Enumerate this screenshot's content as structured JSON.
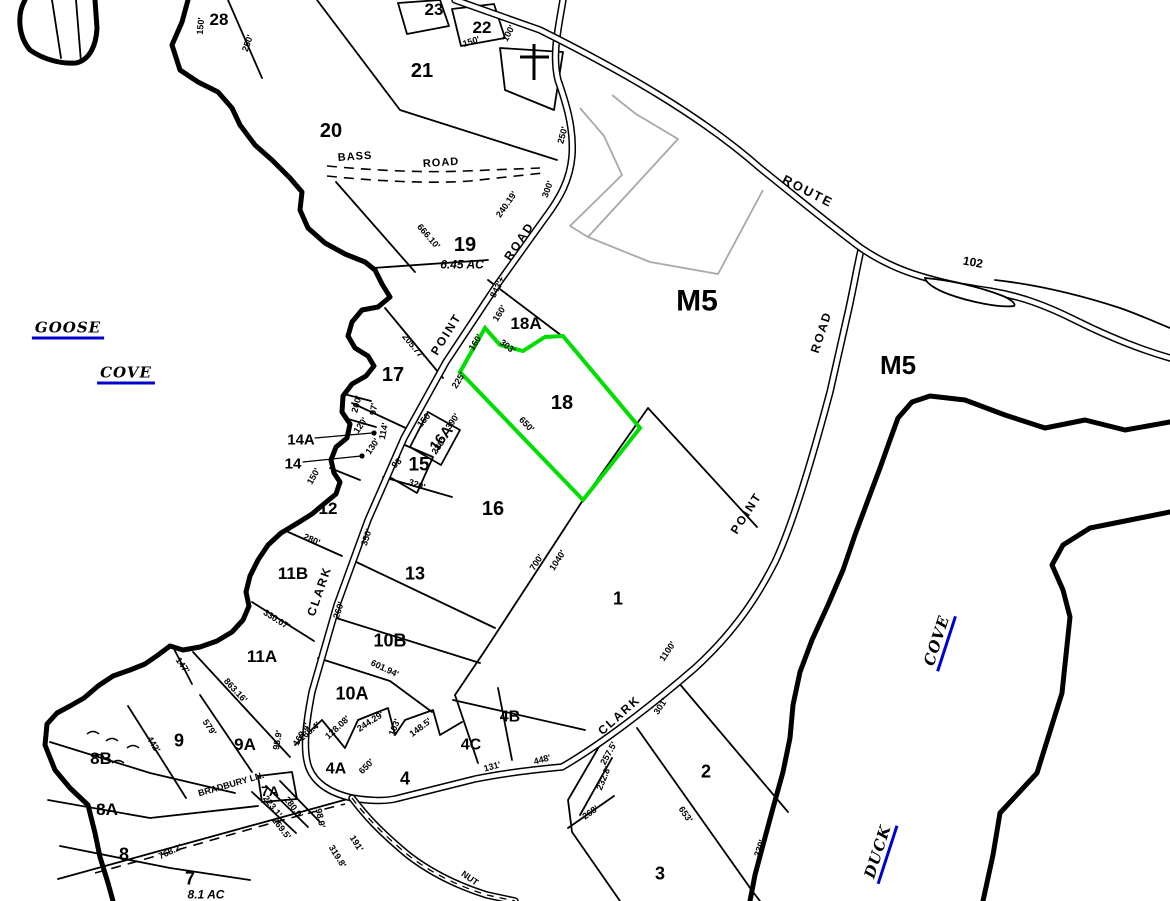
{
  "map": {
    "colors": {
      "highlight_green": "#00dd00",
      "water_label_blue": "#0000cc",
      "subdivision_gray": "#a8a8a8",
      "line_black": "#000000"
    },
    "selected_parcel": "18",
    "region_labels": [
      {
        "text": "28",
        "x": 219,
        "y": 19,
        "size": 17
      },
      {
        "text": "23",
        "x": 434,
        "y": 9,
        "size": 17
      },
      {
        "text": "22",
        "x": 482,
        "y": 27,
        "size": 17
      },
      {
        "text": "21",
        "x": 422,
        "y": 70,
        "size": 20
      },
      {
        "text": "20",
        "x": 331,
        "y": 130,
        "size": 20
      },
      {
        "text": "19",
        "x": 465,
        "y": 244,
        "size": 20
      },
      {
        "text": "18A",
        "x": 526,
        "y": 323,
        "size": 17
      },
      {
        "text": "18",
        "x": 562,
        "y": 402,
        "size": 20
      },
      {
        "text": "17",
        "x": 393,
        "y": 374,
        "size": 20
      },
      {
        "text": "16A",
        "x": 441,
        "y": 438,
        "size": 15,
        "rot": -52
      },
      {
        "text": "15",
        "x": 419,
        "y": 464,
        "size": 19
      },
      {
        "text": "14A",
        "x": 301,
        "y": 439,
        "size": 15
      },
      {
        "text": "14",
        "x": 293,
        "y": 463,
        "size": 15
      },
      {
        "text": "12",
        "x": 328,
        "y": 508,
        "size": 17
      },
      {
        "text": "16",
        "x": 493,
        "y": 508,
        "size": 20
      },
      {
        "text": "11B",
        "x": 293,
        "y": 573,
        "size": 17
      },
      {
        "text": "13",
        "x": 415,
        "y": 573,
        "size": 18
      },
      {
        "text": "11A",
        "x": 262,
        "y": 656,
        "size": 17
      },
      {
        "text": "10B",
        "x": 390,
        "y": 640,
        "size": 18
      },
      {
        "text": "10A",
        "x": 352,
        "y": 693,
        "size": 18
      },
      {
        "text": "9",
        "x": 179,
        "y": 740,
        "size": 18
      },
      {
        "text": "9A",
        "x": 245,
        "y": 744,
        "size": 17
      },
      {
        "text": "8B",
        "x": 101,
        "y": 758,
        "size": 17
      },
      {
        "text": "8A",
        "x": 107,
        "y": 809,
        "size": 17
      },
      {
        "text": "8",
        "x": 124,
        "y": 854,
        "size": 18
      },
      {
        "text": "7",
        "x": 190,
        "y": 878,
        "size": 18
      },
      {
        "text": "7A",
        "x": 270,
        "y": 791,
        "size": 14
      },
      {
        "text": "4A",
        "x": 336,
        "y": 768,
        "size": 16
      },
      {
        "text": "4",
        "x": 405,
        "y": 778,
        "size": 18
      },
      {
        "text": "4C",
        "x": 471,
        "y": 744,
        "size": 16
      },
      {
        "text": "4B",
        "x": 510,
        "y": 716,
        "size": 16
      },
      {
        "text": "2",
        "x": 706,
        "y": 771,
        "size": 18
      },
      {
        "text": "3",
        "x": 660,
        "y": 873,
        "size": 18
      },
      {
        "text": "1",
        "x": 618,
        "y": 598,
        "size": 18
      },
      {
        "text": "M5",
        "x": 697,
        "y": 300,
        "size": 30
      },
      {
        "text": "M5",
        "x": 898,
        "y": 365,
        "size": 26
      }
    ],
    "measurements": [
      {
        "text": "150'",
        "x": 200,
        "y": 26,
        "rot": -85
      },
      {
        "text": "250'",
        "x": 247,
        "y": 43,
        "rot": -70
      },
      {
        "text": "150'",
        "x": 471,
        "y": 41,
        "rot": -18
      },
      {
        "text": "100'",
        "x": 508,
        "y": 33,
        "rot": -62
      },
      {
        "text": "250'",
        "x": 562,
        "y": 135,
        "rot": -75
      },
      {
        "text": "300'",
        "x": 547,
        "y": 189,
        "rot": -70
      },
      {
        "text": "240.19'",
        "x": 506,
        "y": 204,
        "rot": -55
      },
      {
        "text": "666.10'",
        "x": 429,
        "y": 236,
        "rot": 49
      },
      {
        "text": "843'±",
        "x": 497,
        "y": 287,
        "rot": -62
      },
      {
        "text": "160'",
        "x": 499,
        "y": 313,
        "rot": -58
      },
      {
        "text": "160'",
        "x": 475,
        "y": 342,
        "rot": -58
      },
      {
        "text": "303'",
        "x": 508,
        "y": 346,
        "rot": 38
      },
      {
        "text": "205.77'",
        "x": 414,
        "y": 346,
        "rot": 50
      },
      {
        "text": "225'",
        "x": 458,
        "y": 380,
        "rot": -58
      },
      {
        "text": "650'",
        "x": 527,
        "y": 424,
        "rot": 46
      },
      {
        "text": "200'",
        "x": 356,
        "y": 404,
        "rot": -75
      },
      {
        "text": "97'",
        "x": 373,
        "y": 409,
        "rot": -82
      },
      {
        "text": "120'",
        "x": 360,
        "y": 425,
        "rot": -55
      },
      {
        "text": "114'",
        "x": 383,
        "y": 431,
        "rot": -78
      },
      {
        "text": "130'",
        "x": 372,
        "y": 446,
        "rot": -55
      },
      {
        "text": "150'",
        "x": 424,
        "y": 419,
        "rot": -50
      },
      {
        "text": "390'",
        "x": 452,
        "y": 421,
        "rot": -55
      },
      {
        "text": "230'",
        "x": 438,
        "y": 446,
        "rot": -55
      },
      {
        "text": "320'",
        "x": 417,
        "y": 484,
        "rot": 20
      },
      {
        "text": "98'",
        "x": 397,
        "y": 462,
        "rot": -45
      },
      {
        "text": "150'",
        "x": 313,
        "y": 476,
        "rot": -60
      },
      {
        "text": "350'",
        "x": 366,
        "y": 537,
        "rot": -72
      },
      {
        "text": "280'",
        "x": 312,
        "y": 539,
        "rot": 24
      },
      {
        "text": "260'",
        "x": 338,
        "y": 610,
        "rot": -72
      },
      {
        "text": "330.07'",
        "x": 277,
        "y": 619,
        "rot": 32
      },
      {
        "text": "147'",
        "x": 183,
        "y": 665,
        "rot": 55
      },
      {
        "text": "863.16'",
        "x": 236,
        "y": 690,
        "rot": 47
      },
      {
        "text": "579'",
        "x": 210,
        "y": 727,
        "rot": 56
      },
      {
        "text": "442'",
        "x": 154,
        "y": 744,
        "rot": 58
      },
      {
        "text": "95.9'",
        "x": 277,
        "y": 740,
        "rot": -80
      },
      {
        "text": "169.4'",
        "x": 301,
        "y": 734,
        "rot": -60
      },
      {
        "text": "700'",
        "x": 536,
        "y": 562,
        "rot": -57
      },
      {
        "text": "1040'",
        "x": 557,
        "y": 560,
        "rot": -57
      },
      {
        "text": "1100'",
        "x": 667,
        "y": 651,
        "rot": -56
      },
      {
        "text": "601.94'",
        "x": 385,
        "y": 668,
        "rot": 25
      },
      {
        "text": "768.2'",
        "x": 170,
        "y": 851,
        "rot": -25
      },
      {
        "text": "223.1'",
        "x": 273,
        "y": 806,
        "rot": 52
      },
      {
        "text": "280.0'",
        "x": 294,
        "y": 807,
        "rot": 52
      },
      {
        "text": "269.5'",
        "x": 282,
        "y": 828,
        "rot": 52
      },
      {
        "text": "319.8'",
        "x": 338,
        "y": 856,
        "rot": 58
      },
      {
        "text": "191'",
        "x": 357,
        "y": 843,
        "rot": 58
      },
      {
        "text": "98.9'",
        "x": 321,
        "y": 818,
        "rot": 78
      },
      {
        "text": "168.4'",
        "x": 309,
        "y": 731,
        "rot": -40
      },
      {
        "text": "128.08'",
        "x": 337,
        "y": 727,
        "rot": -43
      },
      {
        "text": "244.29'",
        "x": 370,
        "y": 721,
        "rot": -33
      },
      {
        "text": "103'",
        "x": 394,
        "y": 727,
        "rot": -68
      },
      {
        "text": "148.5'",
        "x": 420,
        "y": 727,
        "rot": -37
      },
      {
        "text": "650'",
        "x": 366,
        "y": 766,
        "rot": -45
      },
      {
        "text": "131'",
        "x": 492,
        "y": 766,
        "rot": -15
      },
      {
        "text": "448'",
        "x": 542,
        "y": 759,
        "rot": -15
      },
      {
        "text": "301'",
        "x": 660,
        "y": 706,
        "rot": -56
      },
      {
        "text": "257.5'",
        "x": 608,
        "y": 753,
        "rot": -61
      },
      {
        "text": "232.8'",
        "x": 603,
        "y": 778,
        "rot": -68
      },
      {
        "text": "268'",
        "x": 590,
        "y": 812,
        "rot": -35
      },
      {
        "text": "653'",
        "x": 686,
        "y": 814,
        "rot": 55
      },
      {
        "text": "330'",
        "x": 759,
        "y": 848,
        "rot": -72
      }
    ],
    "road_labels": [
      {
        "text": "ROUTE",
        "x": 808,
        "y": 191,
        "rot": 27,
        "size": 13,
        "ls": 2
      },
      {
        "text": "102",
        "x": 973,
        "y": 262,
        "rot": 10,
        "size": 12
      },
      {
        "text": "ROAD",
        "x": 821,
        "y": 332,
        "rot": -72,
        "size": 12,
        "ls": 2
      },
      {
        "text": "POINT",
        "x": 746,
        "y": 513,
        "rot": -57,
        "size": 12,
        "ls": 2
      },
      {
        "text": "CLARK",
        "x": 619,
        "y": 715,
        "rot": -42,
        "size": 12,
        "ls": 2
      },
      {
        "text": "CLARK",
        "x": 319,
        "y": 591,
        "rot": -71,
        "size": 12,
        "ls": 2
      },
      {
        "text": "POINT",
        "x": 446,
        "y": 334,
        "rot": -58,
        "size": 12,
        "ls": 2
      },
      {
        "text": "ROAD",
        "x": 519,
        "y": 241,
        "rot": -56,
        "size": 12,
        "ls": 2
      },
      {
        "text": "BASS",
        "x": 355,
        "y": 156,
        "rot": -4,
        "size": 11,
        "ls": 1
      },
      {
        "text": "ROAD",
        "x": 441,
        "y": 162,
        "rot": -4,
        "size": 11,
        "ls": 1
      },
      {
        "text": "BRADBURY LN.",
        "x": 231,
        "y": 784,
        "rot": -16,
        "size": 9
      },
      {
        "text": "NUT",
        "x": 470,
        "y": 878,
        "rot": 35,
        "size": 9
      }
    ],
    "water_labels": [
      {
        "text": "GOOSE",
        "x": 68,
        "y": 329,
        "rot": 0
      },
      {
        "text": "COVE",
        "x": 126,
        "y": 374,
        "rot": 0
      },
      {
        "text": "COVE",
        "x": 938,
        "y": 641,
        "rot": -72
      },
      {
        "text": "DUCK",
        "x": 879,
        "y": 852,
        "rot": -72
      }
    ],
    "area_labels": [
      {
        "text": "6.45  AC",
        "x": 462,
        "y": 265
      },
      {
        "text": "8.1  AC",
        "x": 206,
        "y": 895
      }
    ]
  }
}
